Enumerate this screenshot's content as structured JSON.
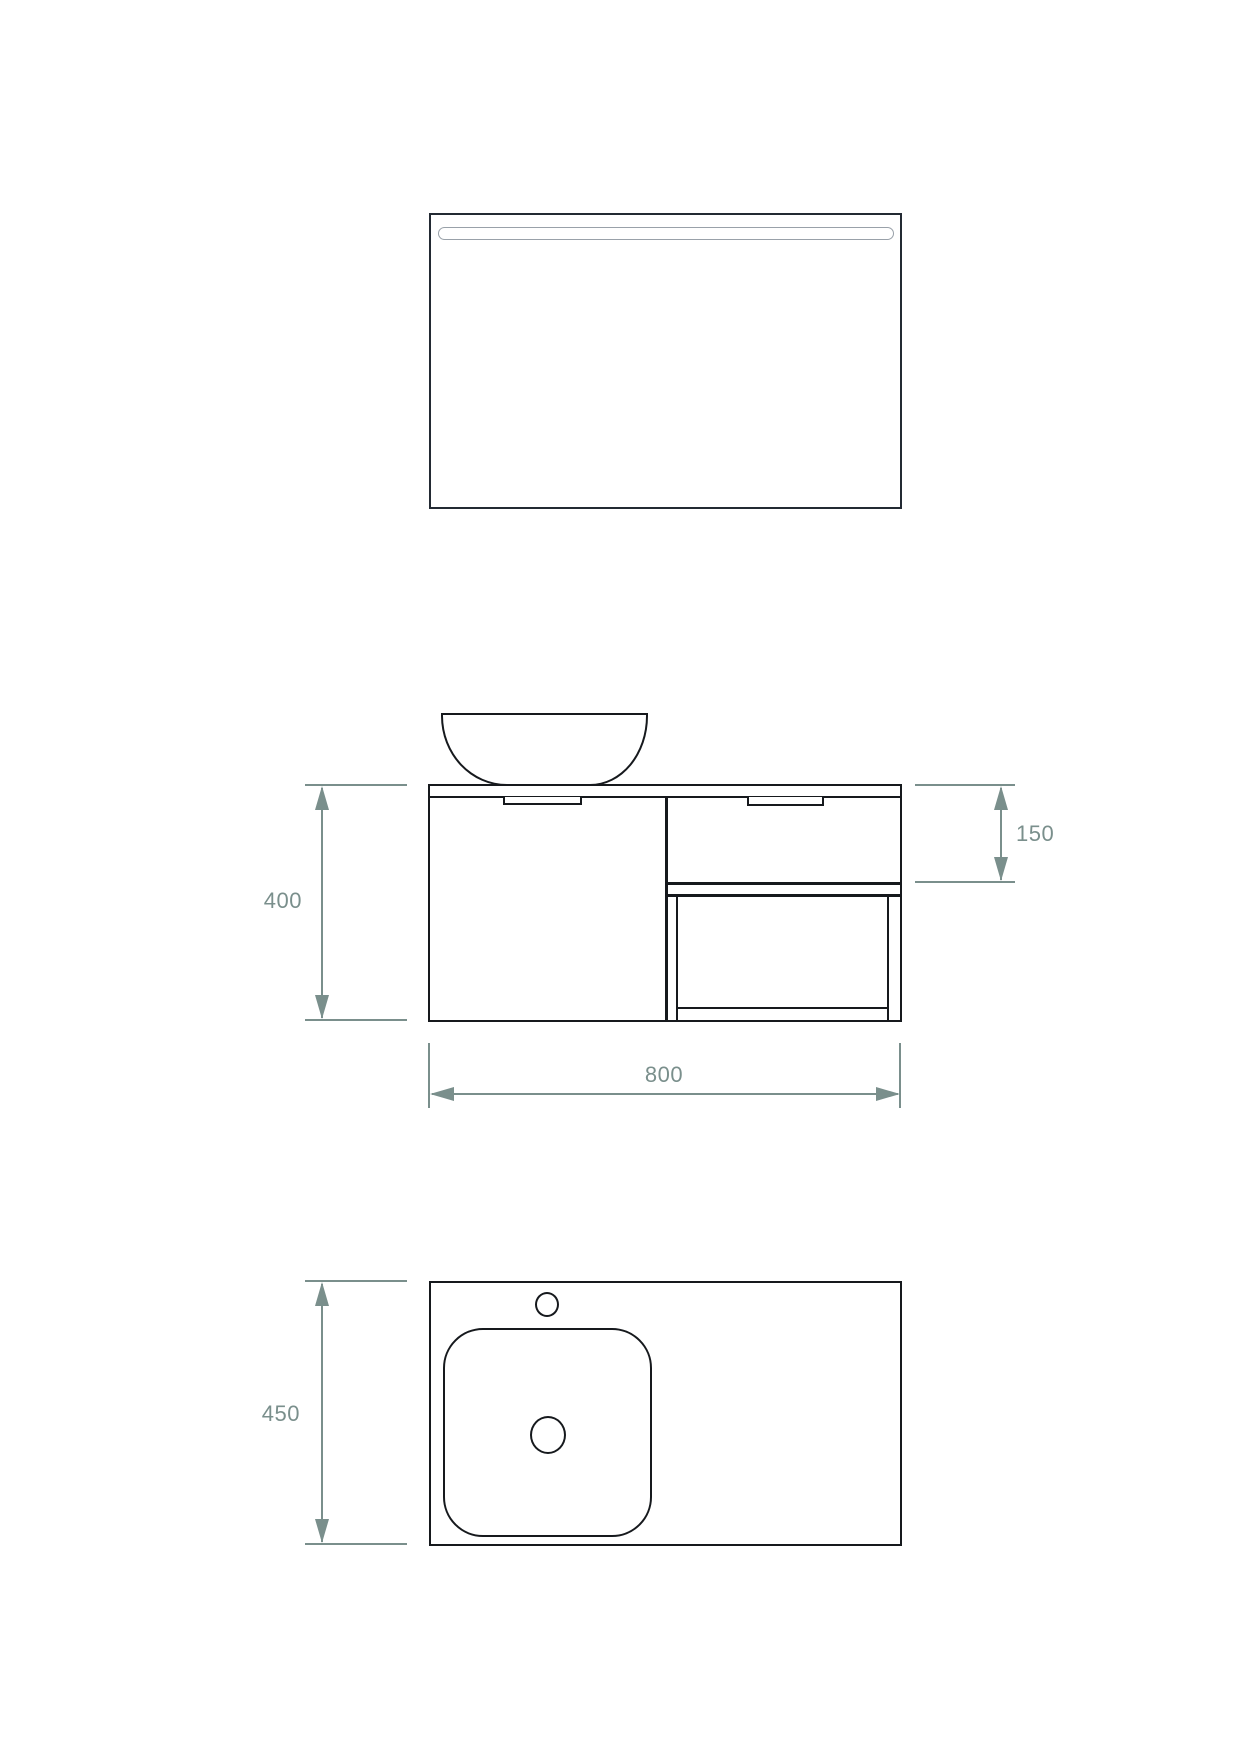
{
  "drawing": {
    "subject": "wall-hung-vanity-unit-with-mirror-three-views"
  },
  "dimensions": {
    "front_height": "400",
    "drawer_front_height": "150",
    "overall_width": "800",
    "worktop_depth": "450"
  },
  "colors": {
    "drawing_line": "#16191d",
    "mirror_line": "#232a33",
    "light_strip_line": "#99a1a9",
    "dimension_accent": "#7a8f8c",
    "background": "#ffffff"
  }
}
